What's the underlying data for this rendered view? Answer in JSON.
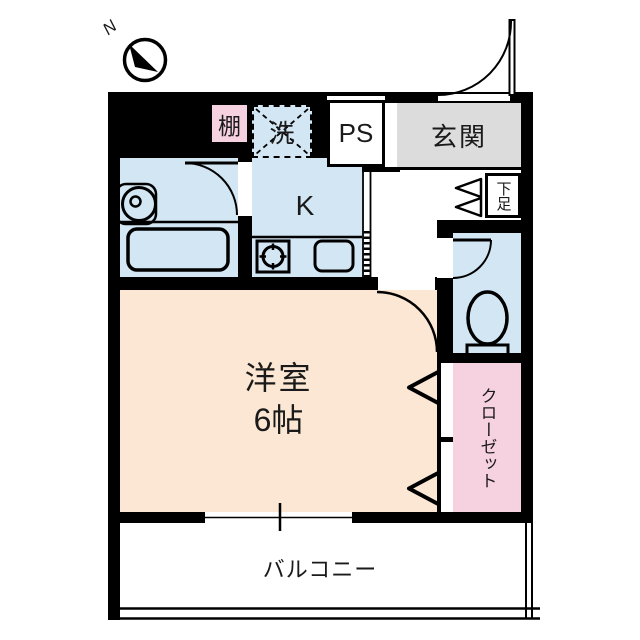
{
  "floorplan": {
    "compass": {
      "north_label": "N"
    },
    "labels": {
      "shelf": "棚",
      "washer": "洗",
      "pipe_space": "PS",
      "entrance": "玄関",
      "shoe_cabinet": "下足",
      "kitchen": "K",
      "main_room_type": "洋室",
      "main_room_size": "6帖",
      "closet": "クローゼット",
      "balcony": "バルコニー"
    },
    "colors": {
      "wall": "#000000",
      "water": "#d3e6f3",
      "pink": "#f6d1e0",
      "peach": "#fbe7d3",
      "gray": "#dcdcdc",
      "line": "#000000"
    }
  }
}
